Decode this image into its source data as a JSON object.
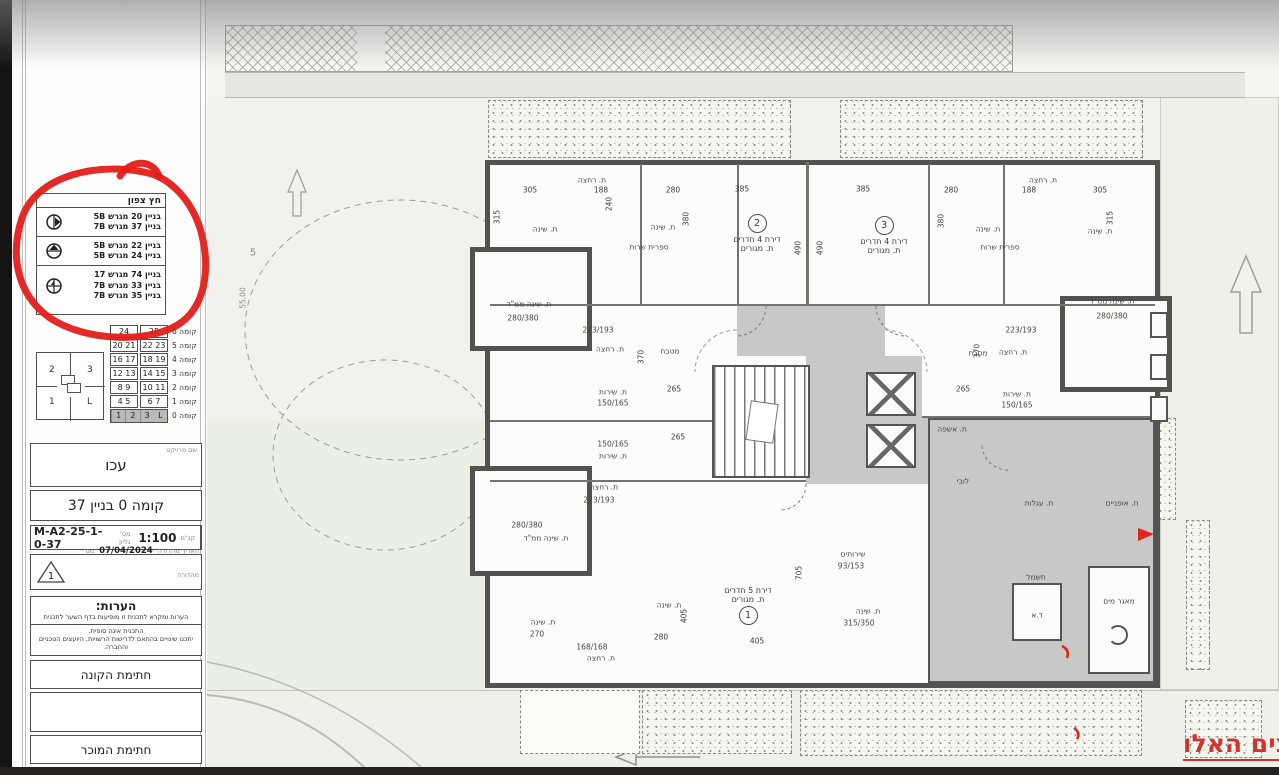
{
  "colors": {
    "annotation_red": "#d0342c",
    "circle_red": "#e41e1a"
  },
  "sidebar": {
    "north_legend": {
      "title": "חץ צפון",
      "rows": [
        {
          "icon": "north-arrow-east-icon",
          "line1": "בניין 20 מגרש 5B",
          "line2": "בניין 37 מגרש 7B",
          "line3": ""
        },
        {
          "icon": "north-arrow-north-icon",
          "line1": "בניין 22 מגרש 5B",
          "line2": "בניין 24 מגרש 5B",
          "line3": ""
        },
        {
          "icon": "north-arrow-cross-icon",
          "line1": "בניין 74 מגרש 17",
          "line2": "בניין 33 מגרש 7B",
          "line3": "בניין 35 מגרש 7B"
        }
      ]
    },
    "floor_table": {
      "rows": [
        {
          "label": "קומה 6",
          "c0": "24",
          "c1": "25"
        },
        {
          "label": "קומה 5",
          "c0": "20  21",
          "c1": "22  23"
        },
        {
          "label": "קומה 4",
          "c0": "16  17",
          "c1": "18  19"
        },
        {
          "label": "קומה 3",
          "c0": "12  13",
          "c1": "14  15"
        },
        {
          "label": "קומה 2",
          "c0": "8  9",
          "c1": "10  11"
        },
        {
          "label": "קומה 1",
          "c0": "4  5",
          "c1": "6  7"
        },
        {
          "label": "קומה 0",
          "c0": "1",
          "c1": "2",
          "c2": "3",
          "c3": "L"
        }
      ]
    },
    "key_plan": {
      "tl": "2",
      "tr": "3",
      "bl": "1",
      "br": "L"
    },
    "project": {
      "label": "שם פרויקט",
      "name": "עכו"
    },
    "sheet_title": "קומה 0 בניין 37",
    "sheet": {
      "number_label": "מס' גליון",
      "number": "M-A2-25-1-0-37",
      "scale_label": "קנ\"מ",
      "scale": "1:100"
    },
    "revision": {
      "triangle": "1",
      "date_label": "תאריך מהדורה",
      "date": "07/04/2024",
      "num_label": "מס' מהדורה",
      "desc_label": "תיאור מהדורה",
      "desc": "תוכנית מכר"
    },
    "notes": {
      "title": "הערות:",
      "line1": "הערות ומקרא לתכנית זו מופיעות בדף השער לתכנית",
      "line2": "התכנית אינה סופית.",
      "line3": "יתכנו שינויים בהתאם לדרישות הרשויות, היועצים הטכניים והחברה."
    },
    "signatures": {
      "buyer": "חתימת הקונה",
      "seller": "חתימת המוכר"
    }
  },
  "plan": {
    "apartments": [
      {
        "num": "2",
        "type": "דירת 4 חדרים",
        "room": "ת. מגורים"
      },
      {
        "num": "3",
        "type": "דירת 4 חדרים",
        "room": "ת. מגורים"
      },
      {
        "num": "1",
        "type": "דירת 5 חדרים",
        "room": "ת. מגורים"
      }
    ],
    "labels": [
      {
        "t": "ת. שינה"
      },
      {
        "t": "ת. שינה"
      },
      {
        "t": "ת. רחצה"
      },
      {
        "t": "ספרית שרות"
      },
      {
        "t": "ת. שינה ממ\"ד"
      },
      {
        "t": "280/380"
      },
      {
        "t": "ת. שינה"
      },
      {
        "t": "ת. שינה"
      },
      {
        "t": "ת. רחצה"
      },
      {
        "t": "ספרית שרות"
      },
      {
        "t": "ת. שינה ממ\"ד"
      },
      {
        "t": "280/380"
      },
      {
        "t": "מטבח"
      },
      {
        "t": "מטבח"
      },
      {
        "t": "ת. רחצה"
      },
      {
        "t": "ת. רחצה"
      },
      {
        "t": "ת. שירות"
      },
      {
        "t": "150/165"
      },
      {
        "t": "150/165"
      },
      {
        "t": "ת. שירות"
      },
      {
        "t": "ת. שירות"
      },
      {
        "t": "150/165"
      },
      {
        "t": "223/193"
      },
      {
        "t": "223/193"
      },
      {
        "t": "ת. רחצה"
      },
      {
        "t": "223/193"
      },
      {
        "t": "ת. שינה ממ\"ד"
      },
      {
        "t": "280/380"
      },
      {
        "t": "ת. שינה"
      },
      {
        "t": "ת. שינה"
      },
      {
        "t": "168/168"
      },
      {
        "t": "ת. רחצה"
      },
      {
        "t": "שירותים"
      },
      {
        "t": "93/153"
      },
      {
        "t": "ת. שינה"
      },
      {
        "t": "315/350"
      },
      {
        "t": "לובי"
      },
      {
        "t": "ת. אשפה"
      },
      {
        "t": "ת. עגלות"
      },
      {
        "t": "ת. אופניים"
      },
      {
        "t": "חשמל"
      },
      {
        "t": "מאגר מים"
      },
      {
        "t": "ד.א"
      },
      {
        "t": "5"
      },
      {
        "t": "55.00"
      }
    ],
    "dims": [
      "305",
      "188",
      "280",
      "385",
      "385",
      "280",
      "188",
      "305",
      "315",
      "240",
      "380",
      "490",
      "490",
      "380",
      "315",
      "370",
      "370",
      "265",
      "265",
      "265",
      "270",
      "280",
      "405",
      "405",
      "705"
    ],
    "annotation": {
      "text": "צים האלו"
    }
  }
}
